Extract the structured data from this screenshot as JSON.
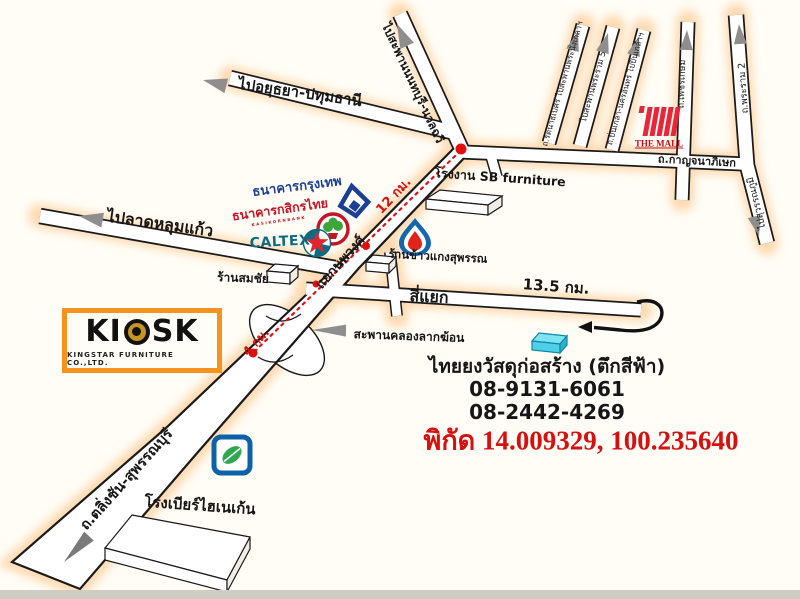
{
  "roads": {
    "to_ayutthaya_pathumthani": "ไปอยุธยา-ปทุมธานี",
    "to_nonthaburi_bridge": "ไปสะพานนนทบุรี-นวลฉวี",
    "to_lat_lum_kaeo": "ไปลาดหลุมแก้ว",
    "taling_chan_suphanburi": "ถ.ตลิ่งชัน-สุพรรณบุรี",
    "kanchanaphisek": "ถ.กาญจนาภิเษก",
    "rattanathibet": "ถ.รัตนาธิเบศร์ ไปสะพานพระนั่งเกล้าฯ",
    "to_rama5_bridge": "ไปสะพานพระราม 5",
    "nakhon_in": "ถ.ปิ่นเกล้า-นครอินทร์ ไปปิ่นเกล้าฯ",
    "phetkasem": "ถ.เพชรเกษม",
    "rama2": "ถ.พระราม 2",
    "to_suvarnabhumi": "ไปสุวรรณภูมิ"
  },
  "junctions": {
    "nopphawong": "แยกนพวงศ์",
    "crossroads": "สี่แยก",
    "lak_khon_bridge": "สะพานคลองลากฆ้อน"
  },
  "distances": {
    "d12": "12 กม.",
    "d4": "4 กม.",
    "d13_5": "13.5 กม."
  },
  "places": {
    "sb_factory": "โรงงาน SB furniture",
    "rice_shop": "ร้านข้าวแกงสุพรรณ",
    "somchai_shop": "ร้านสมชัย",
    "heineken_brewery": "โรงเบียร์ไฮเนเก้น"
  },
  "brands": {
    "bangkok_bank": "ธนาคารกรุงเทพ",
    "kasikorn_bank": "ธนาคารกสิกรไทย",
    "kasikorn_sub": "KASIKORNBANK",
    "caltex": "CALTEX",
    "the_mall": "THE MALL",
    "kiosk_prefix": "KI",
    "kiosk_suffix": "SK",
    "kiosk_sub": "KINGSTAR FURNITURE CO.,LTD."
  },
  "destination": {
    "name": "ไทยยงวัสดุก่อสร้าง (ตึกสีฟ้า)",
    "phone1": "08-9131-6061",
    "phone2": "08-2442-4269",
    "coordinates": "พิกัด 14.009329, 100.235640"
  },
  "icons": {
    "direction_arrow": "➤",
    "u_turn_arrow": "⮌",
    "route_marker": "●",
    "ptt_flame": "flame-drop",
    "bangchak_leaf": "leaf",
    "caltex_star": "★",
    "kiosk_target": "◉"
  },
  "colors": {
    "route_red": "#e01010",
    "coordinates_red": "#d60f0f",
    "road_glow_orange": "#ffbe7a",
    "bangkok_bank_blue": "#1b3f94",
    "kasikorn_red": "#c41425",
    "kasikorn_green": "#3da63b",
    "caltex_teal": "#0c6b80",
    "caltex_star_red": "#e0252e",
    "mall_red": "#e8253a",
    "ptt_blue": "#1467ae",
    "ptt_red": "#e2231a",
    "bangchak_blue": "#0b62a8",
    "bangchak_green": "#2fa84f",
    "kiosk_orange": "#f6921e",
    "destination_building_cyan": "#4fd0e8",
    "arrow_gray": "#8e8e8e"
  }
}
